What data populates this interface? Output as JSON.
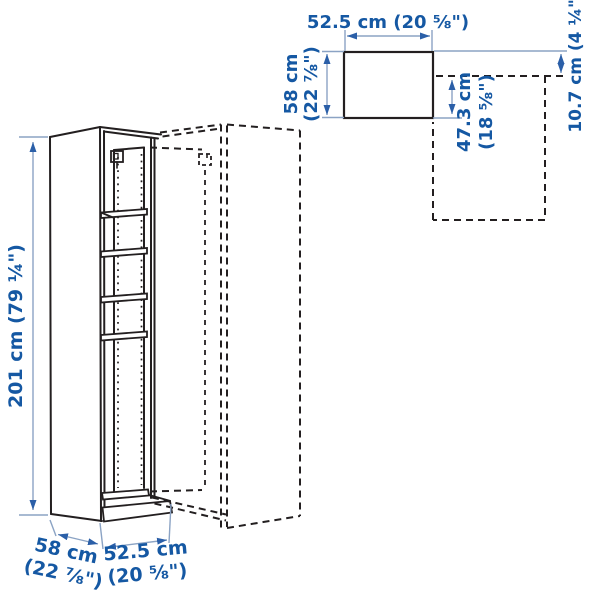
{
  "diagram_title": "wardrobe-add-on-corner-unit-dimension-diagram",
  "colors": {
    "text": "#1558a3",
    "arrow": "#2b5fa8",
    "dim_line": "#8ba3c4",
    "drawing_line": "#231f20",
    "background": "#ffffff"
  },
  "dimensions": {
    "height": "201 cm (79 ¼\")",
    "top_width": "52.5 cm (20 ⅝\")",
    "top_depth": [
      "58 cm",
      "(22 ⅞\")"
    ],
    "inner_depth": [
      "47.3 cm",
      "(18 ⅝\")"
    ],
    "side_offset": "10.7 cm (4 ¼\")",
    "base_depth": [
      "58 cm",
      "(22 ⅞\")"
    ],
    "base_width": [
      "52.5 cm",
      "(20 ⅝\")"
    ]
  }
}
